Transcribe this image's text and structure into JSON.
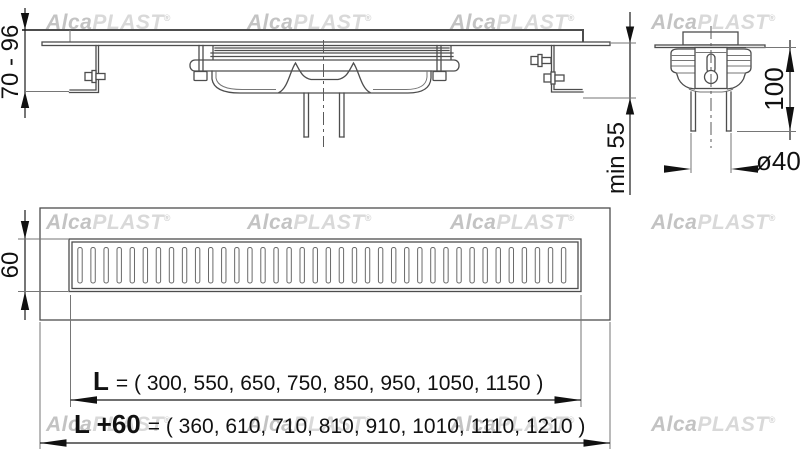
{
  "brand": {
    "name_part1": "Alca",
    "name_part2": "PLAST",
    "registered": "®"
  },
  "watermark": {
    "rows_y": [
      11,
      211,
      413
    ],
    "cols_x": [
      46,
      247,
      450,
      651
    ]
  },
  "front_view": {
    "adjustable_height": "70 - 96",
    "min_installation_depth": "min 55"
  },
  "side_view": {
    "outlet_depth": "100",
    "outlet_diameter": "ø40"
  },
  "plan_view": {
    "channel_width": "60",
    "grate_slot_count": 38,
    "length": {
      "label": "L",
      "eq_values": "= ( 300, 550, 650, 750, 850, 950, 1050, 1150 )"
    },
    "length_plus": {
      "label": "L +60",
      "eq_values": "= ( 360, 610, 710, 810, 910, 1010, 1110, 1210 )"
    }
  },
  "colors": {
    "background": "#ffffff",
    "drawing_line": "#4d4d4d",
    "dimension": "#111111",
    "watermark_dark": "#c3c3c3",
    "watermark_light": "#d9d9d9"
  }
}
